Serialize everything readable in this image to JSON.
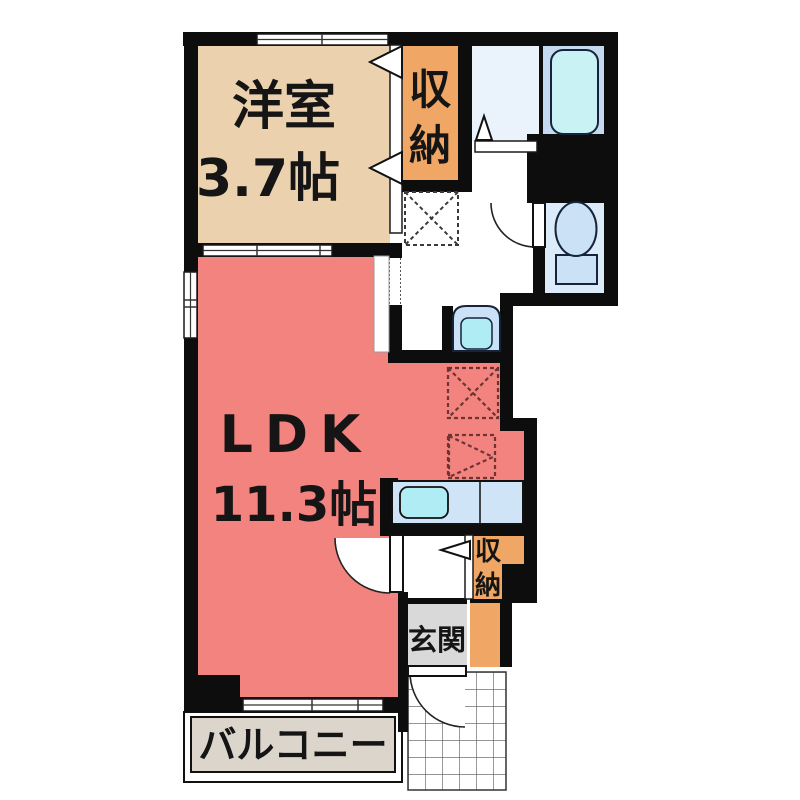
{
  "plan_title": "1LDK apartment floor plan",
  "rooms": {
    "western_room": {
      "name": "洋室",
      "size": "3.7帖"
    },
    "ldk": {
      "name": "LDK",
      "size": "11.3帖"
    },
    "closet_upper": {
      "char1": "収",
      "char2": "納"
    },
    "closet_lower": {
      "char1": "収",
      "char2": "納"
    },
    "entrance": {
      "name": "玄関"
    },
    "balcony": {
      "name": "バルコニー"
    }
  },
  "colors": {
    "wall": "#0d0d0d",
    "western_room": "#ecd1af",
    "closet": "#f0a765",
    "ldk": "#f2837e",
    "washroom": "#eaf2fb",
    "bathroom": "#c5daf0",
    "bathtub": "#c9f2f4",
    "toilet_room": "#dcebfa",
    "fixture_blue": "#cbe2f6",
    "sink_cyan": "#b0ecf4",
    "counter": "#cfe4f6",
    "entrance_gray": "#d9d9d9",
    "balcony_beige": "#dbd5cb",
    "porch_tile_line": "#555555"
  }
}
